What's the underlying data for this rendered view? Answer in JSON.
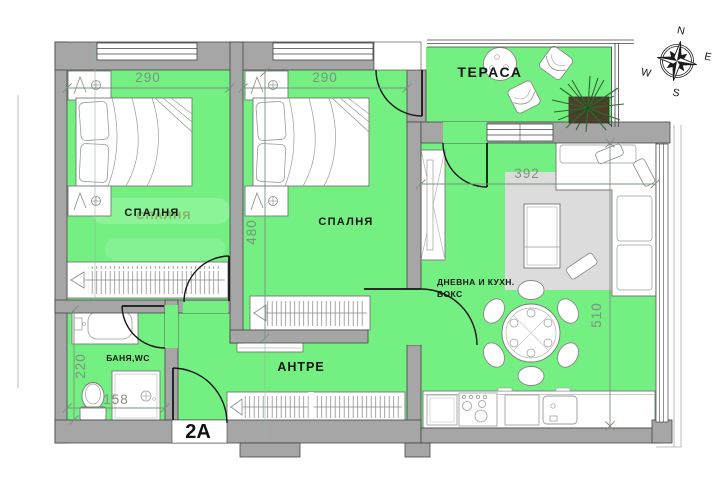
{
  "plan": {
    "unit_label": "2A",
    "rooms": {
      "bedroom1": {
        "label": "СПАЛНЯ"
      },
      "bedroom2": {
        "label": "СПАЛНЯ"
      },
      "terrace": {
        "label": "ТЕРАСА"
      },
      "living": {
        "label_line1": "ДНЕВНА И КУХН.",
        "label_line2": "БОКС"
      },
      "hall": {
        "label": "АНТРЕ"
      },
      "bathroom": {
        "label": "БАНЯ,WC"
      }
    },
    "dimensions_cm": {
      "bedroom1_width": "290",
      "bedroom2_width": "290",
      "bedroom2_depth": "480",
      "living_width": "392",
      "living_depth": "510",
      "bathroom_depth": "220",
      "bathroom_width": "158"
    },
    "compass": {
      "n": "N",
      "e": "E",
      "s": "S",
      "w": "W"
    },
    "colors": {
      "room_fill": "#74ef82",
      "wall_fill": "#a6a6a6",
      "dimension_text": "#7d917f",
      "rug": "#dcdcdc"
    }
  }
}
